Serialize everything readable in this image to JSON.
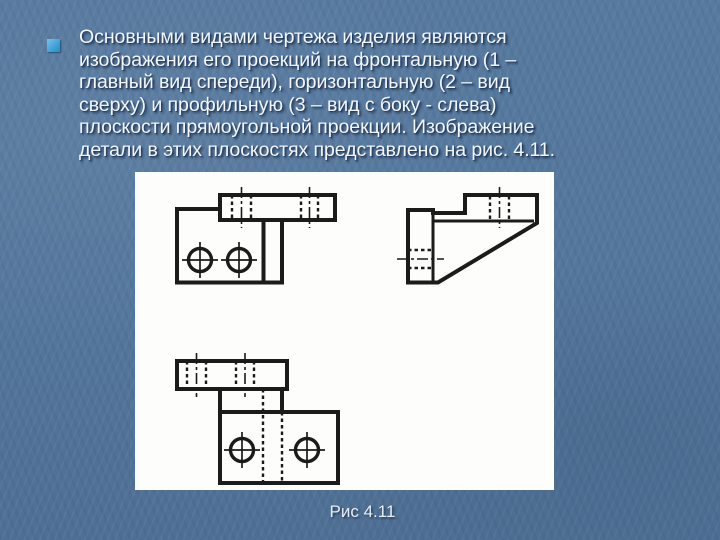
{
  "slide": {
    "background_color": "#55789d",
    "bullet": {
      "color": "#42a4dc"
    },
    "text": {
      "color": "#f3f6fa",
      "lines": [
        "Основными видами чертежа изделия являются",
        "изображения его проекций на фронтальную (1 –",
        "главный вид спереди), горизонтальную (2 – вид",
        "сверху) и профильную (3 – вид с боку - слева)",
        "плоскости прямоугольной проекции. Изображение",
        "детали в этих плоскостях представлено на рис. 4.11."
      ]
    },
    "figure": {
      "caption": "Рис 4.11",
      "panel_background": "#fdfdfb",
      "line_color": "#1b1b1b",
      "views": [
        "front-view",
        "side-view",
        "top-view"
      ]
    }
  }
}
